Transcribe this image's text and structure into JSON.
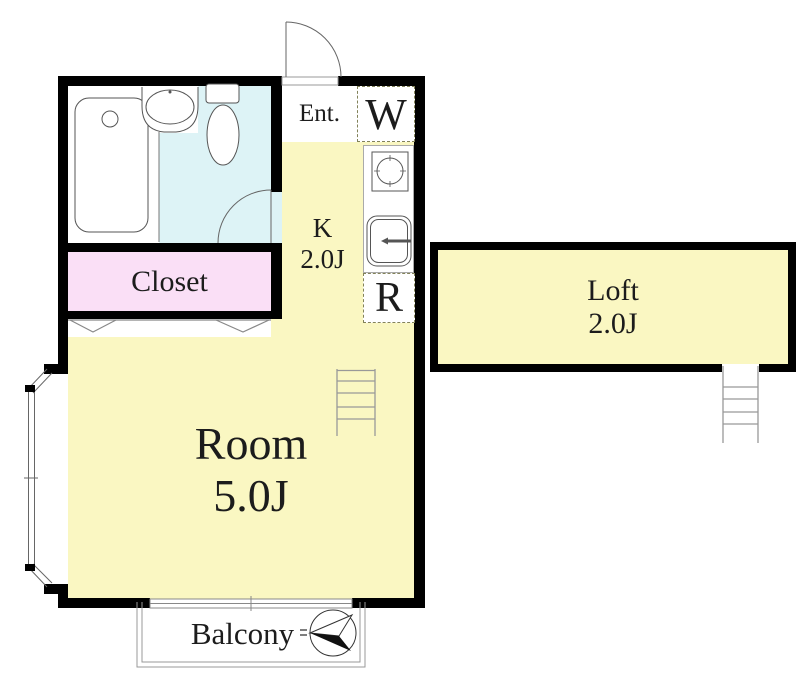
{
  "labels": {
    "entrance": "Ent.",
    "washer": "W",
    "kitchen_name": "K",
    "kitchen_size": "2.0J",
    "refrigerator": "R",
    "closet": "Closet",
    "room_name": "Room",
    "room_size": "5.0J",
    "loft_name": "Loft",
    "loft_size": "2.0J",
    "balcony": "Balcony"
  },
  "colors": {
    "floor_yellow": "#FAF7C2",
    "bathroom_blue": "#DDF3F6",
    "closet_pink": "#FADFF6",
    "wall": "#000000",
    "dashed_outline": "#82825A"
  },
  "icons": [
    "bathtub-icon",
    "washbasin-icon",
    "toilet-icon",
    "entrance-door-icon",
    "bathroom-door-icon",
    "stove-icon",
    "kitchen-sink-icon",
    "closet-folding-door-icon",
    "bay-window-icon",
    "sliding-window-icon",
    "balcony-railing",
    "room-ladder-icon",
    "loft-ladder-icon",
    "compass-icon"
  ]
}
